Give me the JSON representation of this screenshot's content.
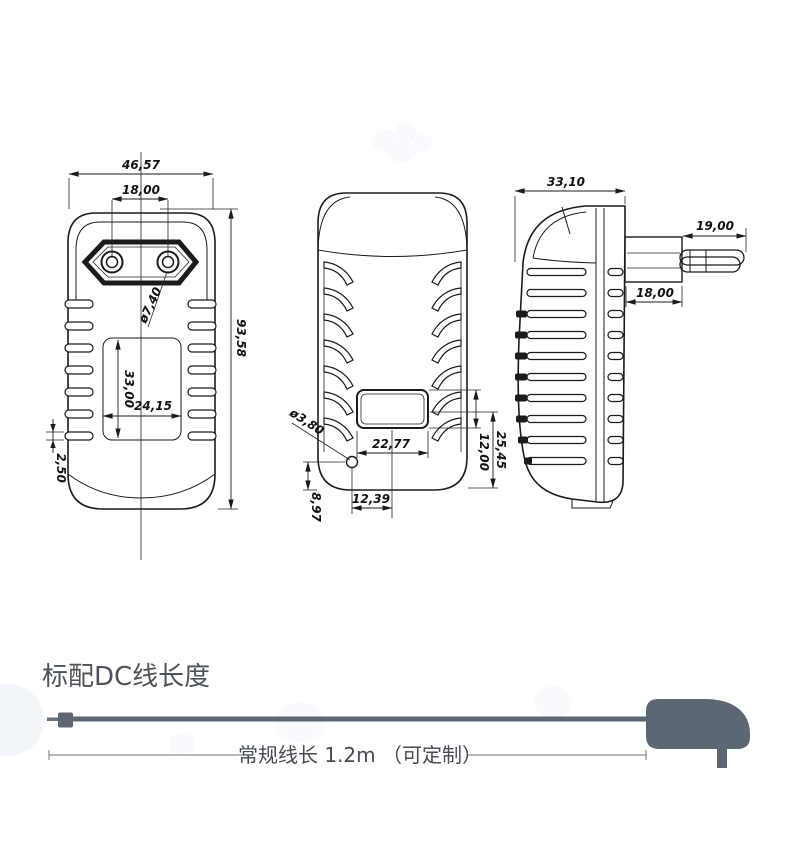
{
  "front_view": {
    "overall_width": "46,57",
    "pin_pitch": "18,00",
    "pin_diameter": "ø7,40",
    "overall_height": "93,58",
    "recess_height": "33,00",
    "recess_width": "24,15",
    "vent_slot_height": "2,50"
  },
  "back_view": {
    "hole_diameter": "ø3,80",
    "recess_width": "22,77",
    "hole_offset": "12,39",
    "hole_height": "8,97",
    "recess_bottom_offset": "25,45",
    "recess_height": "12,00"
  },
  "side_view": {
    "body_depth": "33,10",
    "pin_length": "19,00",
    "plug_base_depth": "18,00"
  },
  "cable_section": {
    "heading": "标配DC线长度",
    "cable_note": "常规线长 1.2m （可定制）"
  },
  "colors": {
    "line": "#1b1b1b",
    "cable_gray": "#5d6673",
    "heading_text": "#4d5358"
  }
}
